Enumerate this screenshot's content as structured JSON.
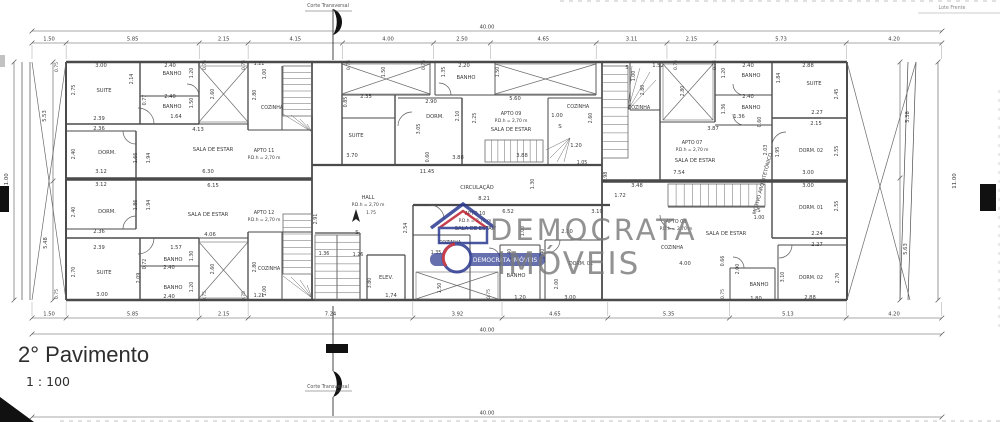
{
  "page": {
    "background": "#ffffff",
    "line_color": "#4a4a4a",
    "thin_color": "#6a6a6a",
    "text_color": "#3a3a3a"
  },
  "title_block": {
    "title": "2° Pavimento",
    "scale": "1 : 100"
  },
  "section_markers": {
    "top_label": "Corte Transversal",
    "bottom_label": "Corte Transversal"
  },
  "site_note": "Lote Frente",
  "watermark": {
    "line1": "DEMOCRATA",
    "line2": "IMÓVEIS",
    "color": "#7a7a7a",
    "logo": {
      "house_color": "#2b3990",
      "roof_color": "#be1e2d",
      "bar_text": "DEMOCRATA IMÓVEIS"
    }
  },
  "dim_rows": [
    {
      "name": "top-total",
      "y": 31,
      "x0": 32,
      "values": [
        "40.00"
      ],
      "ext": false
    },
    {
      "name": "top-segments",
      "y": 43,
      "x0": 32,
      "values": [
        "1.50",
        "5.85",
        "2.15",
        "4.15",
        "4.00",
        "2.50",
        "4.65",
        "3.11",
        "2.15",
        "5.73",
        "4.20"
      ],
      "ext": "down"
    },
    {
      "name": "bottom-segments",
      "y": 318,
      "x0": 32,
      "values": [
        "1.50",
        "5.85",
        "2.15",
        "7.24",
        "3.92",
        "4.65",
        "5.35",
        "5.13",
        "4.20"
      ],
      "ext": "up"
    },
    {
      "name": "bottom-total",
      "y": 334,
      "x0": 32,
      "values": [
        "40.00"
      ],
      "ext": false
    },
    {
      "name": "sheet-bottom",
      "y": 417,
      "x0": 32,
      "values": [
        "40.00"
      ],
      "ext": false
    }
  ],
  "labels": [
    {
      "t": "11.00",
      "x": 8,
      "y": 181,
      "r": -90,
      "s": 5.4
    },
    {
      "t": "5.53",
      "x": 46,
      "y": 116,
      "r": -90
    },
    {
      "t": "5.48",
      "x": 47,
      "y": 243,
      "r": -90
    },
    {
      "t": "0.75",
      "x": 58,
      "y": 67,
      "r": -90,
      "s": 4.6
    },
    {
      "t": "0.75",
      "x": 58,
      "y": 294,
      "r": -90,
      "s": 4.6
    },
    {
      "t": "3.00",
      "x": 101,
      "y": 67
    },
    {
      "t": "2.75",
      "x": 75,
      "y": 90,
      "r": -90,
      "s": 4.8
    },
    {
      "t": "SUITE",
      "x": 104,
      "y": 92
    },
    {
      "t": "2.39",
      "x": 99,
      "y": 120
    },
    {
      "t": "2.36",
      "x": 99,
      "y": 130
    },
    {
      "t": "2.14",
      "x": 133,
      "y": 79,
      "r": -90,
      "s": 4.8
    },
    {
      "t": "2.40",
      "x": 170,
      "y": 67
    },
    {
      "t": "BANHO",
      "x": 172,
      "y": 75
    },
    {
      "t": "1.20",
      "x": 193,
      "y": 73,
      "r": -90,
      "s": 4.8
    },
    {
      "t": "0.77",
      "x": 146,
      "y": 100,
      "r": -90,
      "s": 4.8
    },
    {
      "t": "2.40",
      "x": 170,
      "y": 98
    },
    {
      "t": "BANHO",
      "x": 172,
      "y": 108
    },
    {
      "t": "1.50",
      "x": 193,
      "y": 103,
      "r": -90,
      "s": 4.8
    },
    {
      "t": "1.64",
      "x": 176,
      "y": 118
    },
    {
      "t": "4.13",
      "x": 198,
      "y": 131
    },
    {
      "t": "0.75",
      "x": 206,
      "y": 65,
      "r": -90,
      "s": 4.6
    },
    {
      "t": "0.75",
      "x": 245,
      "y": 65,
      "r": -90,
      "s": 4.6
    },
    {
      "t": "2.60",
      "x": 214,
      "y": 94,
      "r": -90,
      "s": 4.8
    },
    {
      "t": "2.80",
      "x": 256,
      "y": 95,
      "r": -90,
      "s": 4.8
    },
    {
      "t": "1.21",
      "x": 259,
      "y": 65,
      "s": 4.8
    },
    {
      "t": "1.00",
      "x": 266,
      "y": 74,
      "r": -90,
      "s": 4.8
    },
    {
      "t": "COZINHA",
      "x": 272,
      "y": 109,
      "s": 4.8
    },
    {
      "t": "2.40",
      "x": 75,
      "y": 154,
      "r": -90,
      "s": 4.8
    },
    {
      "t": "DORM.",
      "x": 107,
      "y": 154
    },
    {
      "t": "1.66",
      "x": 137,
      "y": 158,
      "r": -90,
      "s": 4.8
    },
    {
      "t": "1.94",
      "x": 150,
      "y": 158,
      "r": -90,
      "s": 4.8
    },
    {
      "t": "SALA DE ESTAR",
      "x": 213,
      "y": 151
    },
    {
      "t": "APTO 11",
      "x": 264,
      "y": 152,
      "s": 4.8
    },
    {
      "t": "P.D.h = 2,70 m",
      "x": 264,
      "y": 159,
      "s": 4.4
    },
    {
      "t": "3.12",
      "x": 101,
      "y": 173
    },
    {
      "t": "6.30",
      "x": 208,
      "y": 173
    },
    {
      "t": "3.12",
      "x": 101,
      "y": 186
    },
    {
      "t": "6.15",
      "x": 213,
      "y": 187
    },
    {
      "t": "2.40",
      "x": 75,
      "y": 212,
      "r": -90,
      "s": 4.8
    },
    {
      "t": "DORM.",
      "x": 107,
      "y": 213
    },
    {
      "t": "1.86",
      "x": 137,
      "y": 205,
      "r": -90,
      "s": 4.8
    },
    {
      "t": "1.94",
      "x": 150,
      "y": 205,
      "r": -90,
      "s": 4.8
    },
    {
      "t": "SALA DE ESTAR",
      "x": 208,
      "y": 216
    },
    {
      "t": "APTO 12",
      "x": 264,
      "y": 214,
      "s": 4.8
    },
    {
      "t": "P.D.h = 2,70 m",
      "x": 264,
      "y": 221,
      "s": 4.4
    },
    {
      "t": "2.36",
      "x": 99,
      "y": 233
    },
    {
      "t": "4.06",
      "x": 210,
      "y": 236
    },
    {
      "t": "2.39",
      "x": 99,
      "y": 249
    },
    {
      "t": "1.57",
      "x": 176,
      "y": 249
    },
    {
      "t": "BANHO",
      "x": 173,
      "y": 261
    },
    {
      "t": "1.30",
      "x": 193,
      "y": 256,
      "r": -90,
      "s": 4.8
    },
    {
      "t": "2.40",
      "x": 169,
      "y": 269
    },
    {
      "t": "0.72",
      "x": 146,
      "y": 264,
      "r": -90,
      "s": 4.8
    },
    {
      "t": "2.70",
      "x": 75,
      "y": 272,
      "r": -90,
      "s": 4.8
    },
    {
      "t": "SUITE",
      "x": 104,
      "y": 274
    },
    {
      "t": "2.09",
      "x": 140,
      "y": 278,
      "r": -90,
      "s": 4.8
    },
    {
      "t": "BANHO",
      "x": 173,
      "y": 289
    },
    {
      "t": "2.40",
      "x": 169,
      "y": 298
    },
    {
      "t": "1.20",
      "x": 193,
      "y": 287,
      "r": -90,
      "s": 4.8
    },
    {
      "t": "3.00",
      "x": 102,
      "y": 296
    },
    {
      "t": "0.75",
      "x": 206,
      "y": 296,
      "r": -90,
      "s": 4.6
    },
    {
      "t": "0.75",
      "x": 245,
      "y": 296,
      "r": -90,
      "s": 4.6
    },
    {
      "t": "2.60",
      "x": 214,
      "y": 269,
      "r": -90,
      "s": 4.8
    },
    {
      "t": "2.80",
      "x": 256,
      "y": 267,
      "r": -90,
      "s": 4.8
    },
    {
      "t": "1.21",
      "x": 259,
      "y": 297,
      "s": 4.8
    },
    {
      "t": "1.00",
      "x": 266,
      "y": 291,
      "r": -90,
      "s": 4.8
    },
    {
      "t": "COZINHA",
      "x": 269,
      "y": 270,
      "s": 4.8
    },
    {
      "t": "0.75",
      "x": 350,
      "y": 65,
      "r": -90,
      "s": 4.6
    },
    {
      "t": "1.50",
      "x": 385,
      "y": 72,
      "r": -90,
      "s": 4.8
    },
    {
      "t": "0.75",
      "x": 425,
      "y": 65,
      "r": -90,
      "s": 4.6
    },
    {
      "t": "2.35",
      "x": 366,
      "y": 98
    },
    {
      "t": "0.85",
      "x": 347,
      "y": 102,
      "r": -90,
      "s": 4.8
    },
    {
      "t": "SUITE",
      "x": 356,
      "y": 137
    },
    {
      "t": "3.70",
      "x": 352,
      "y": 157
    },
    {
      "t": "3.05",
      "x": 420,
      "y": 129,
      "r": -90,
      "s": 4.8
    },
    {
      "t": "1.35",
      "x": 445,
      "y": 72,
      "r": -90,
      "s": 4.8
    },
    {
      "t": "2.20",
      "x": 464,
      "y": 67
    },
    {
      "t": "BANHO",
      "x": 466,
      "y": 79
    },
    {
      "t": "1.50",
      "x": 499,
      "y": 72,
      "r": -90,
      "s": 4.8
    },
    {
      "t": "2.90",
      "x": 431,
      "y": 103
    },
    {
      "t": "DORM.",
      "x": 435,
      "y": 118
    },
    {
      "t": "2.10",
      "x": 459,
      "y": 116,
      "r": -90,
      "s": 4.8
    },
    {
      "t": "2.25",
      "x": 476,
      "y": 118,
      "r": -90,
      "s": 4.8
    },
    {
      "t": "0.60",
      "x": 429,
      "y": 157,
      "r": -90,
      "s": 4.8
    },
    {
      "t": "3.88",
      "x": 458,
      "y": 159
    },
    {
      "t": "5.60",
      "x": 515,
      "y": 100
    },
    {
      "t": "APTO 09",
      "x": 511,
      "y": 115,
      "s": 4.8
    },
    {
      "t": "P.D.h = 2,70 m",
      "x": 511,
      "y": 122,
      "s": 4.4
    },
    {
      "t": "SALA DE ESTAR",
      "x": 511,
      "y": 131
    },
    {
      "t": "1.00",
      "x": 557,
      "y": 117
    },
    {
      "t": "S",
      "x": 560,
      "y": 128,
      "s": 5.5
    },
    {
      "t": "2.60",
      "x": 592,
      "y": 118,
      "r": -90,
      "s": 4.8
    },
    {
      "t": "COZINHA",
      "x": 578,
      "y": 108,
      "s": 4.8
    },
    {
      "t": "1.20",
      "x": 576,
      "y": 147
    },
    {
      "t": "1.05",
      "x": 582,
      "y": 164,
      "s": 4.8
    },
    {
      "t": "3.88",
      "x": 522,
      "y": 157
    },
    {
      "t": "11.45",
      "x": 427,
      "y": 173
    },
    {
      "t": "CIRCULAÇÃO",
      "x": 477,
      "y": 189
    },
    {
      "t": "8.21",
      "x": 484,
      "y": 200
    },
    {
      "t": "1.30",
      "x": 534,
      "y": 184,
      "r": -90,
      "s": 4.8
    },
    {
      "t": "0.98",
      "x": 607,
      "y": 177,
      "r": -90,
      "s": 4.8
    },
    {
      "t": "3.48",
      "x": 637,
      "y": 187
    },
    {
      "t": "1.72",
      "x": 620,
      "y": 197
    },
    {
      "t": "HALL",
      "x": 368,
      "y": 199,
      "s": 5
    },
    {
      "t": "P.D.h = 2,70 m",
      "x": 368,
      "y": 206,
      "s": 4.4
    },
    {
      "t": "1.75",
      "x": 371,
      "y": 214,
      "s": 4.4
    },
    {
      "t": "S",
      "x": 357,
      "y": 234,
      "s": 5.5
    },
    {
      "t": "2.91",
      "x": 317,
      "y": 219,
      "r": -90,
      "s": 4.8
    },
    {
      "t": "1.36",
      "x": 324,
      "y": 255,
      "s": 4.8
    },
    {
      "t": "1.26",
      "x": 358,
      "y": 256,
      "s": 4.8
    },
    {
      "t": "2.54",
      "x": 407,
      "y": 228,
      "r": -90,
      "s": 4.8
    },
    {
      "t": "ELEV.",
      "x": 386,
      "y": 279
    },
    {
      "t": "3.80",
      "x": 371,
      "y": 283,
      "r": -90,
      "s": 4.8
    },
    {
      "t": "1,74",
      "x": 391,
      "y": 297
    },
    {
      "t": "APTO 10",
      "x": 475,
      "y": 215,
      "s": 4.8
    },
    {
      "t": "6.52",
      "x": 508,
      "y": 213
    },
    {
      "t": "P.D.h = 2,70 m",
      "x": 475,
      "y": 222,
      "s": 4.4
    },
    {
      "t": "SALA DE ESTAR",
      "x": 475,
      "y": 230
    },
    {
      "t": "3.10",
      "x": 597,
      "y": 213
    },
    {
      "t": "1.00",
      "x": 524,
      "y": 231,
      "r": -90,
      "s": 4.8
    },
    {
      "t": "2.10",
      "x": 567,
      "y": 233
    },
    {
      "t": "COZINHA",
      "x": 450,
      "y": 244,
      "s": 4.8
    },
    {
      "t": "1.35",
      "x": 436,
      "y": 254,
      "s": 4.8
    },
    {
      "t": "2.40",
      "x": 511,
      "y": 254,
      "r": -90,
      "s": 4.8
    },
    {
      "t": "3.40",
      "x": 544,
      "y": 254,
      "r": -90,
      "s": 4.8
    },
    {
      "t": "DORM. 01",
      "x": 581,
      "y": 265,
      "s": 4.8
    },
    {
      "t": "2.00",
      "x": 558,
      "y": 284,
      "r": -90,
      "s": 4.8
    },
    {
      "t": "BANHO",
      "x": 516,
      "y": 277
    },
    {
      "t": "1.20",
      "x": 520,
      "y": 299
    },
    {
      "t": "3.00",
      "x": 570,
      "y": 299
    },
    {
      "t": "1.50",
      "x": 441,
      "y": 288,
      "r": -90,
      "s": 4.8
    },
    {
      "t": "0.75",
      "x": 490,
      "y": 294,
      "r": -90,
      "s": 4.6
    },
    {
      "t": "COZINHA",
      "x": 639,
      "y": 109,
      "s": 4.8
    },
    {
      "t": "S",
      "x": 627,
      "y": 69,
      "s": 5
    },
    {
      "t": "1.00",
      "x": 635,
      "y": 76,
      "r": -90,
      "s": 4.8
    },
    {
      "t": "1.52",
      "x": 658,
      "y": 67
    },
    {
      "t": "2.80",
      "x": 644,
      "y": 90,
      "r": -90,
      "s": 4.8
    },
    {
      "t": "0.75",
      "x": 677,
      "y": 65,
      "r": -90,
      "s": 4.6
    },
    {
      "t": "2.80",
      "x": 684,
      "y": 91,
      "r": -90,
      "s": 4.8
    },
    {
      "t": "3.87",
      "x": 713,
      "y": 130
    },
    {
      "t": "0.75",
      "x": 716,
      "y": 65,
      "r": -90,
      "s": 4.6
    },
    {
      "t": "1.20",
      "x": 725,
      "y": 73,
      "r": -90,
      "s": 4.8
    },
    {
      "t": "2.40",
      "x": 748,
      "y": 67
    },
    {
      "t": "BANHO",
      "x": 751,
      "y": 77
    },
    {
      "t": "1.84",
      "x": 780,
      "y": 78,
      "r": -90,
      "s": 4.8
    },
    {
      "t": "2.88",
      "x": 808,
      "y": 67
    },
    {
      "t": "SUITE",
      "x": 814,
      "y": 85
    },
    {
      "t": "2.45",
      "x": 838,
      "y": 94,
      "r": -90,
      "s": 4.8
    },
    {
      "t": "2.40",
      "x": 748,
      "y": 98
    },
    {
      "t": "BANHO",
      "x": 751,
      "y": 109
    },
    {
      "t": "1.36",
      "x": 725,
      "y": 109,
      "r": -90,
      "s": 4.8
    },
    {
      "t": "1.36",
      "x": 739,
      "y": 118
    },
    {
      "t": "0.60",
      "x": 761,
      "y": 122,
      "r": -90,
      "s": 4.8
    },
    {
      "t": "2.27",
      "x": 817,
      "y": 114
    },
    {
      "t": "2.15",
      "x": 816,
      "y": 125
    },
    {
      "t": "APTO 07",
      "x": 692,
      "y": 144,
      "s": 4.8
    },
    {
      "t": "P.D.h = 2,70 m",
      "x": 692,
      "y": 151,
      "s": 4.4
    },
    {
      "t": "SALA DE ESTAR",
      "x": 695,
      "y": 162
    },
    {
      "t": "2.03",
      "x": 767,
      "y": 150,
      "r": -90,
      "s": 4.8
    },
    {
      "t": "1.95",
      "x": 779,
      "y": 152,
      "r": -90,
      "s": 4.8
    },
    {
      "t": "DORM. 02",
      "x": 811,
      "y": 152,
      "s": 4.8
    },
    {
      "t": "2.55",
      "x": 838,
      "y": 151,
      "r": -90,
      "s": 4.8
    },
    {
      "t": "7.54",
      "x": 679,
      "y": 174
    },
    {
      "t": "3.00",
      "x": 808,
      "y": 174
    },
    {
      "t": "3.00",
      "x": 808,
      "y": 187
    },
    {
      "t": "MOTIVO ARQUITETÔNICO",
      "x": 764,
      "y": 184,
      "r": -75,
      "s": 5
    },
    {
      "t": "S",
      "x": 759,
      "y": 212,
      "s": 5
    },
    {
      "t": "1.00",
      "x": 759,
      "y": 219,
      "s": 4.8
    },
    {
      "t": "APTO 08",
      "x": 676,
      "y": 223,
      "s": 4.8
    },
    {
      "t": "P.D.h = 2,70 m",
      "x": 676,
      "y": 230,
      "s": 4.4
    },
    {
      "t": "SALA DE ESTAR",
      "x": 726,
      "y": 235
    },
    {
      "t": "DORM. 01",
      "x": 811,
      "y": 209,
      "s": 4.8
    },
    {
      "t": "2.55",
      "x": 838,
      "y": 206,
      "r": -90,
      "s": 4.8
    },
    {
      "t": "2.24",
      "x": 817,
      "y": 235
    },
    {
      "t": "2.27",
      "x": 817,
      "y": 246
    },
    {
      "t": "COZINHA",
      "x": 672,
      "y": 249,
      "s": 4.8
    },
    {
      "t": "4.00",
      "x": 685,
      "y": 265
    },
    {
      "t": "0.66",
      "x": 724,
      "y": 261,
      "r": -90,
      "s": 4.8
    },
    {
      "t": "2.00",
      "x": 739,
      "y": 269,
      "r": -90,
      "s": 4.8
    },
    {
      "t": "3.10",
      "x": 784,
      "y": 277,
      "r": -90,
      "s": 4.8
    },
    {
      "t": "DORM. 02",
      "x": 811,
      "y": 279,
      "s": 4.8
    },
    {
      "t": "2.70",
      "x": 839,
      "y": 278,
      "r": -90,
      "s": 4.8
    },
    {
      "t": "BANHO",
      "x": 759,
      "y": 286
    },
    {
      "t": "1.80",
      "x": 756,
      "y": 300
    },
    {
      "t": "2.88",
      "x": 810,
      "y": 299
    },
    {
      "t": "0.75",
      "x": 724,
      "y": 294,
      "r": -90,
      "s": 4.6
    },
    {
      "t": "5.38",
      "x": 909,
      "y": 117,
      "r": -90
    },
    {
      "t": "5.63",
      "x": 907,
      "y": 249,
      "r": -90
    },
    {
      "t": "11.00",
      "x": 956,
      "y": 181,
      "r": -90,
      "s": 5.4
    }
  ]
}
